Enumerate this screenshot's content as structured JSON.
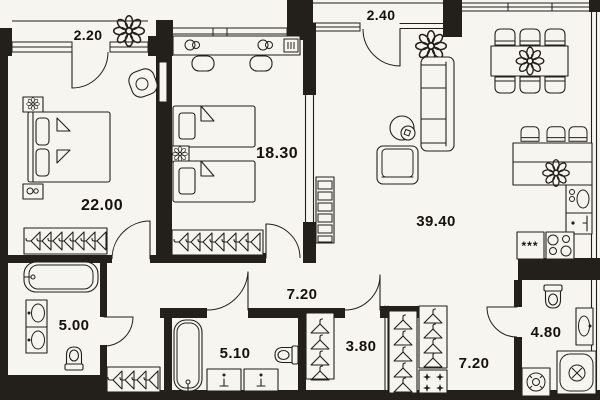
{
  "plan": {
    "type": "apartment-floor-plan",
    "colors": {
      "background": "#f6f5f0",
      "wall": "#23201b",
      "line": "#23201b",
      "text": "#14110e"
    },
    "rooms": [
      {
        "name": "balcony-small",
        "label": "2.20"
      },
      {
        "name": "bedroom-master",
        "label": "22.00"
      },
      {
        "name": "bedroom-second",
        "label": "18.30"
      },
      {
        "name": "balcony-top",
        "label": "2.40"
      },
      {
        "name": "living-kitchen",
        "label": "39.40"
      },
      {
        "name": "hallway",
        "label": "7.20"
      },
      {
        "name": "bathroom-left",
        "label": "5.00"
      },
      {
        "name": "bathroom-middle",
        "label": "5.10"
      },
      {
        "name": "closet",
        "label": "3.80"
      },
      {
        "name": "wardrobe-hall",
        "label": "7.20"
      },
      {
        "name": "bathroom-entry",
        "label": "4.80"
      }
    ],
    "kitchen": {
      "fridge_label": "***"
    },
    "icons": [
      "double-bed",
      "single-bed",
      "wardrobe-hangers",
      "clothes-hanger",
      "plant-flower",
      "sofa",
      "armchair",
      "floor-lamp",
      "dining-table",
      "dining-chair",
      "bar-stool",
      "fridge",
      "stove",
      "oven",
      "kitchen-sink",
      "bathtub",
      "wash-basin",
      "toilet",
      "washing-machine",
      "shower",
      "door-arc",
      "window",
      "shelving"
    ]
  }
}
